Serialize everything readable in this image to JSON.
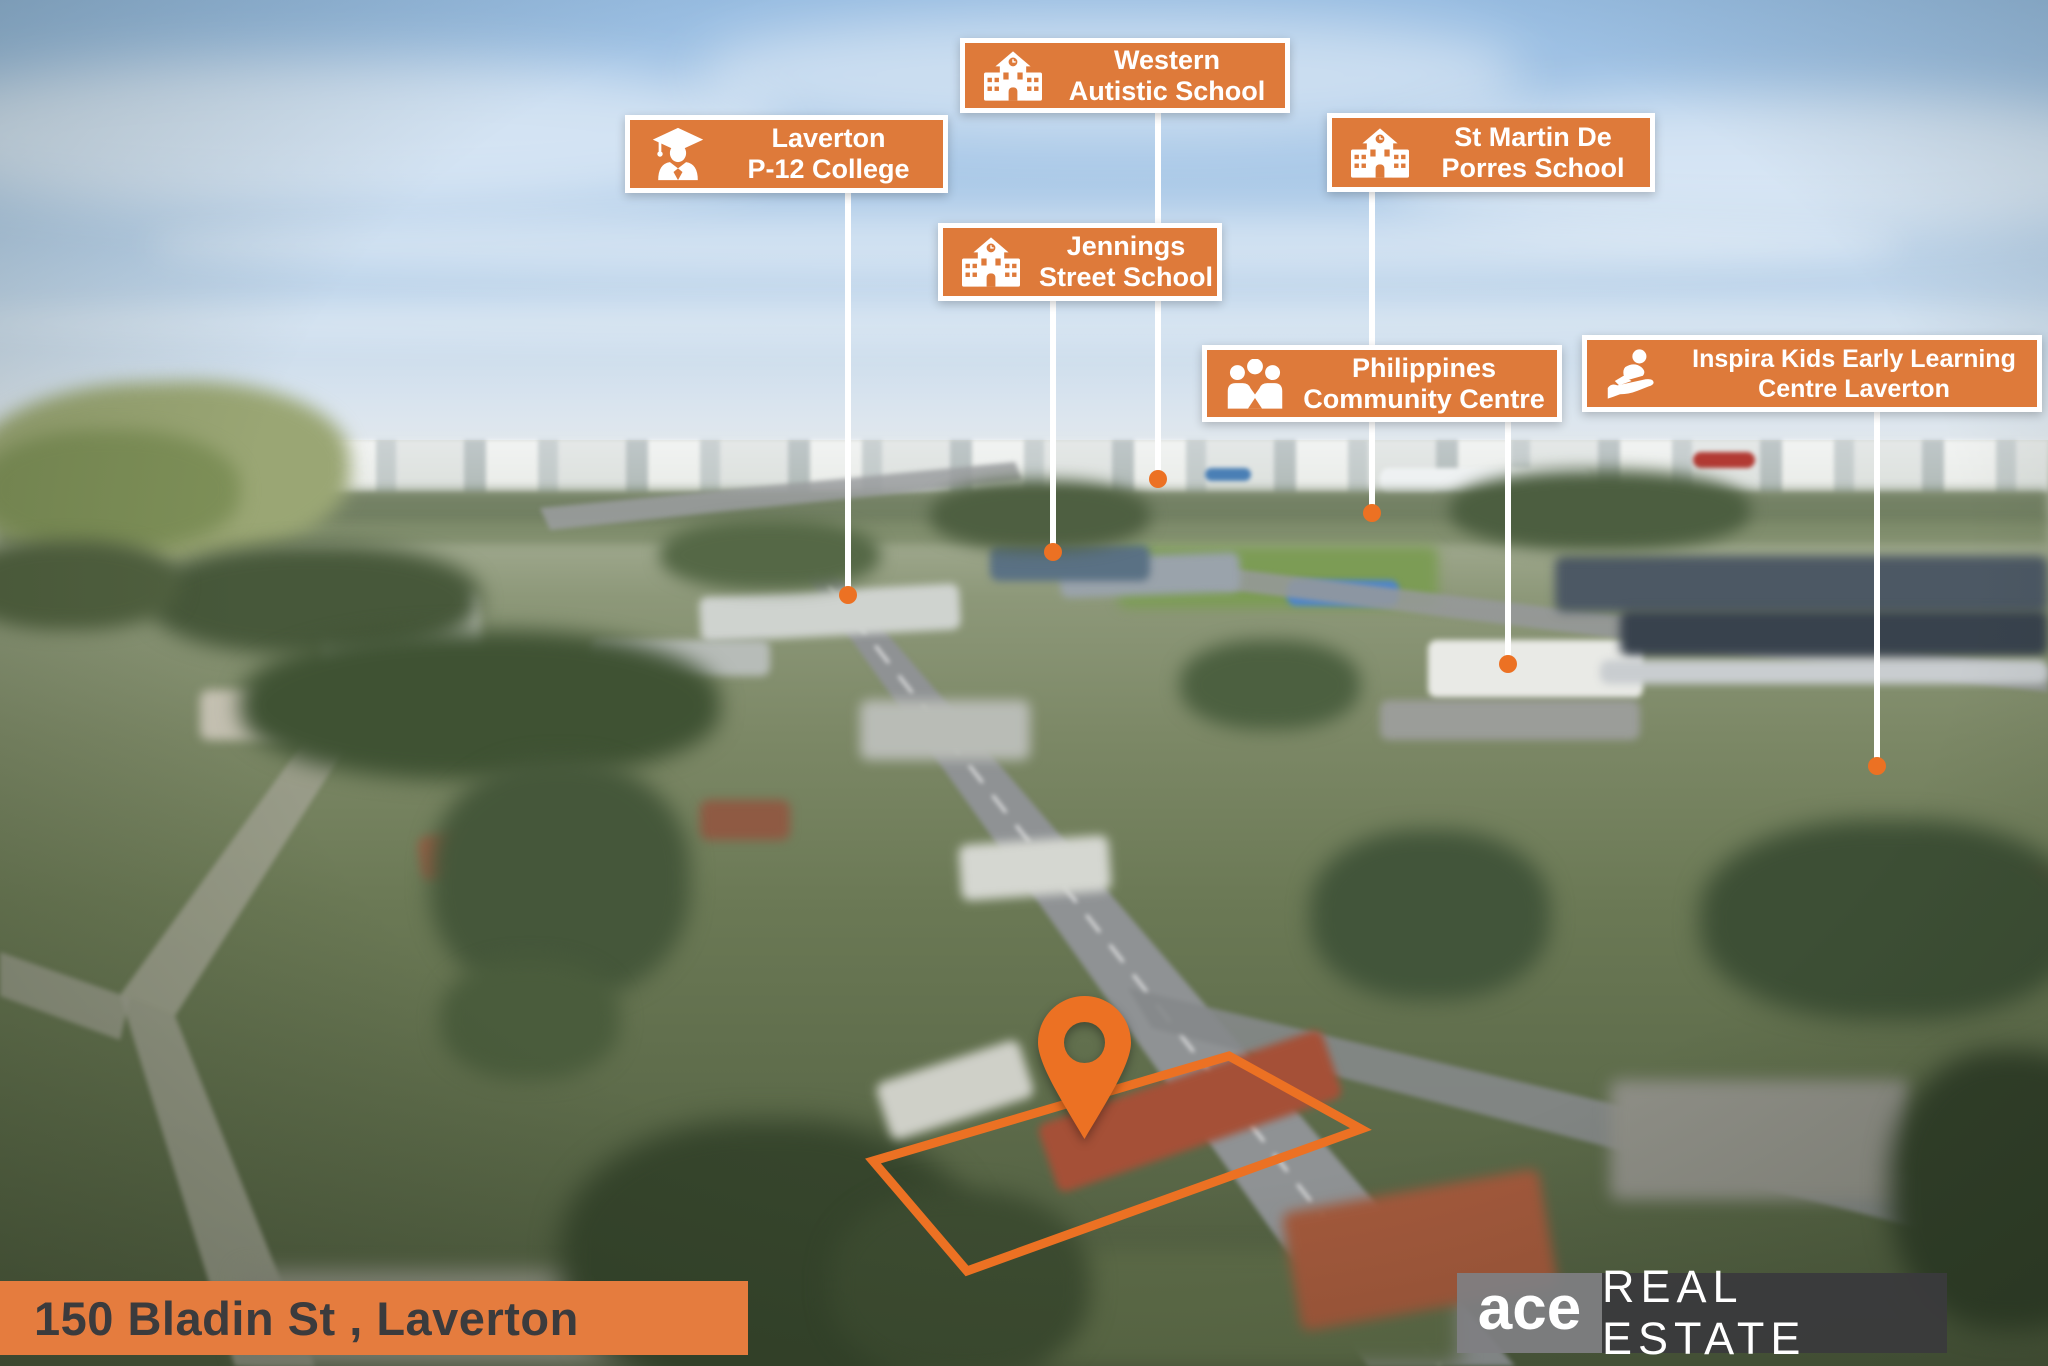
{
  "callouts": [
    {
      "name": "Laverton P-12 College",
      "icon": "graduate-icon",
      "line1": "Laverton",
      "line2": "P-12 College"
    },
    {
      "name": "Western Autistic School",
      "icon": "school-icon",
      "line1": "Western",
      "line2": "Autistic School"
    },
    {
      "name": "Jennings Street School",
      "icon": "school-icon",
      "line1": "Jennings",
      "line2": "Street School"
    },
    {
      "name": "St Martin De Porres School",
      "icon": "school-icon",
      "line1": "St Martin De",
      "line2": "Porres School"
    },
    {
      "name": "Philippines Community Centre",
      "icon": "community-icon",
      "line1": "Philippines",
      "line2": "Community Centre"
    },
    {
      "name": "Inspira Kids Early Learning Centre Laverton",
      "icon": "child-on-hand-icon",
      "line1": "Inspira Kids Early Learning",
      "line2": "Centre Laverton"
    }
  ],
  "address_banner": {
    "text": "150 Bladin St , Laverton"
  },
  "brand": {
    "name": "ace",
    "tagline": "REAL ESTATE"
  },
  "colors": {
    "label_orange": "#DE7A3A",
    "marker_orange": "#EC7123",
    "banner_orange": "#E57C3E",
    "banner_text": "#3B3B3D",
    "ace_gray": "#7F7F82",
    "estate_gray": "#3A3A3C",
    "leader_white": "#FFFFFF"
  }
}
